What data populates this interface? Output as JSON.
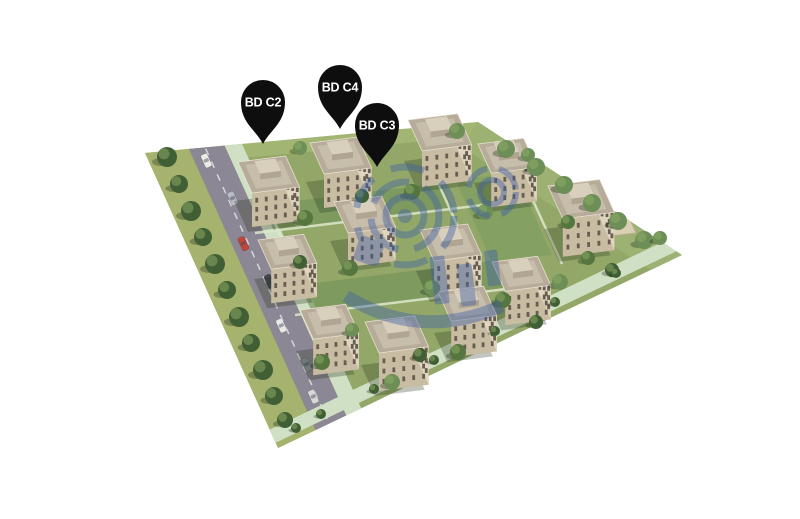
{
  "scene": {
    "type": "aerial-3d-site-plan",
    "description": "Isometric aerial 3D render of a residential development: rows of cream apartment blocks with roof terraces, green courtyards, a tree-lined road on the left, a sand court on the right, a translucent blue watermark over the centre, all on a plain white background",
    "background": "#ffffff"
  },
  "markers": [
    {
      "id": "bd-c2",
      "label": "BD C2",
      "x": 263,
      "y": 144
    },
    {
      "id": "bd-c4",
      "label": "BD C4",
      "x": 340,
      "y": 129
    },
    {
      "id": "bd-c3",
      "label": "BD C3",
      "x": 377,
      "y": 167
    }
  ],
  "colors": {
    "pin": "#0e0e0e",
    "pin_text": "#ffffff",
    "grass": "#93a868",
    "road": "#8b8794",
    "path": "#cfe0c4",
    "building_wall_light": "#e0d6c0",
    "building_wall_dark": "#c8bca2",
    "building_window": "#675d50",
    "roof": "#b6ac99",
    "roof_inset": "#c6bdab",
    "tree": "#55763f",
    "tree_light": "#6d8f57",
    "tree_dark": "#415f35",
    "sand_court": "#d9cfb2",
    "watermark": "#3e5fa8"
  }
}
